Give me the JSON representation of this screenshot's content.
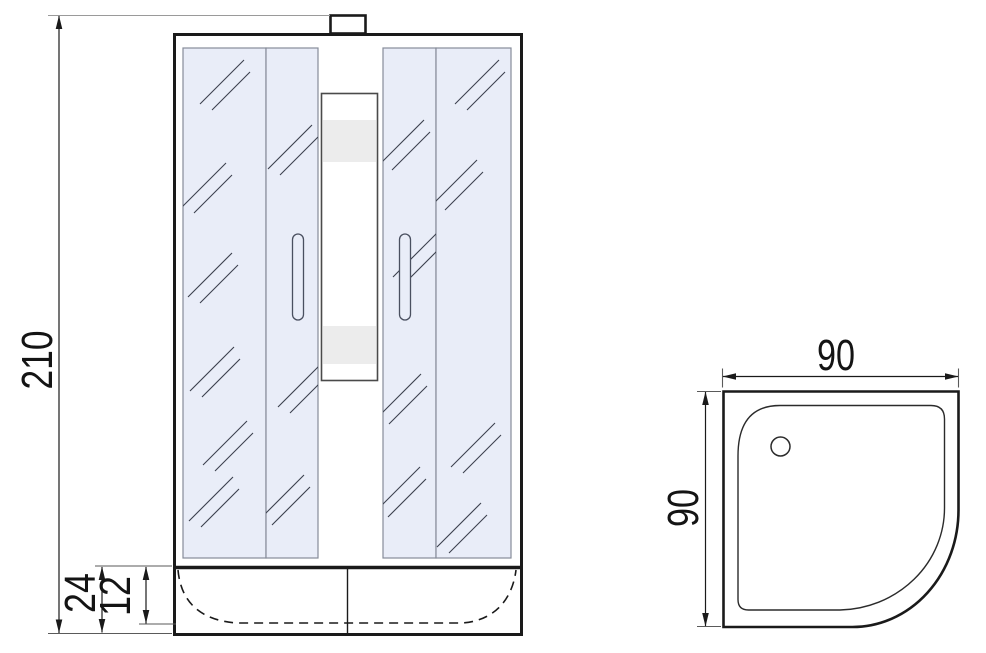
{
  "front_view": {
    "dim_height": "210",
    "dim_tray_height": "24",
    "dim_basin_depth": "12"
  },
  "top_view": {
    "dim_width": "90",
    "dim_depth": "90"
  },
  "colors": {
    "line": "#1a1a1a",
    "glass_fill": "#e9edf8",
    "glass_border": "#868c99",
    "shelf_band": "#ececec",
    "handle_outline": "#4a5060",
    "background": "#ffffff"
  }
}
